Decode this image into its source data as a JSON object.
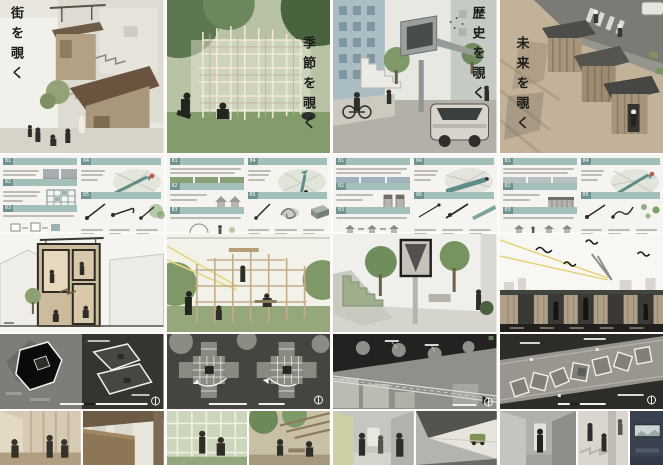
{
  "board": {
    "kind": "architecture-presentation-board-set",
    "panel_count": 4
  },
  "panels": [
    {
      "id": "machi",
      "title": "街を覗く",
      "sections": [
        {
          "no": "01"
        },
        {
          "no": "02"
        },
        {
          "no": "03"
        },
        {
          "no": "04"
        },
        {
          "no": "05"
        }
      ]
    },
    {
      "id": "kisetsu",
      "title": "季節を覗く",
      "sections": [
        {
          "no": "01"
        },
        {
          "no": "02"
        },
        {
          "no": "03"
        },
        {
          "no": "04"
        },
        {
          "no": "05"
        }
      ]
    },
    {
      "id": "rekishi",
      "title": "歴史を覗く",
      "sections": [
        {
          "no": "01"
        },
        {
          "no": "02"
        },
        {
          "no": "03"
        },
        {
          "no": "04"
        },
        {
          "no": "05"
        }
      ]
    },
    {
      "id": "mirai",
      "title": "未来を覗く",
      "sections": [
        {
          "no": "01"
        },
        {
          "no": "02"
        },
        {
          "no": "03"
        },
        {
          "no": "04"
        },
        {
          "no": "05"
        }
      ]
    }
  ],
  "colors": {
    "accent_teal": "#a3bfba",
    "accent_teal_dark": "#6f948f",
    "map_arrow_teal": "#5d8d86",
    "marker_red": "#c4574e",
    "plan_dark_bg": "#35342f",
    "title_ink": "#1c1c19",
    "paper_bg": "#f5f4f0"
  }
}
